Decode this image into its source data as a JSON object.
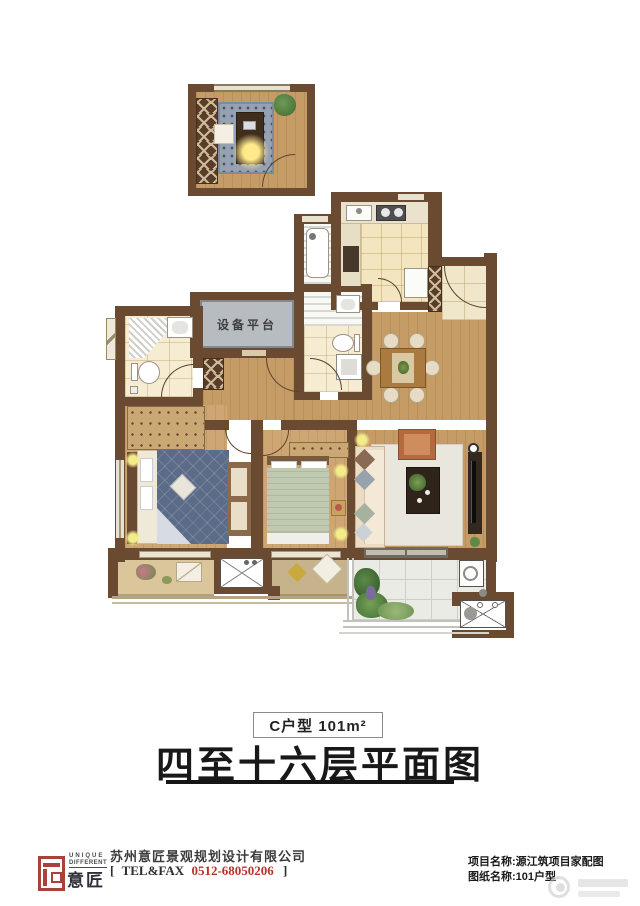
{
  "plan": {
    "unit_label": "C户型 101m²",
    "title": "四至十六层平面图",
    "platform_label": "设备平台"
  },
  "footer": {
    "logo": {
      "line1": "UNIQUE",
      "line2": "DIFFERENT",
      "brand": "意匠"
    },
    "company": "苏州意匠景观规划设计有限公司",
    "tel": {
      "open": "[",
      "label": "TEL&FAX",
      "number": "0512-68050206",
      "close": "]"
    },
    "project_line": "项目名称:源江筑项目家配图",
    "drawing_line": "图纸名称:101户型"
  },
  "colors": {
    "wall": "#6a4a31",
    "logo_red": "#a8423a",
    "tel_red": "#b5342a",
    "platform_gray": "#b7bcc0"
  }
}
